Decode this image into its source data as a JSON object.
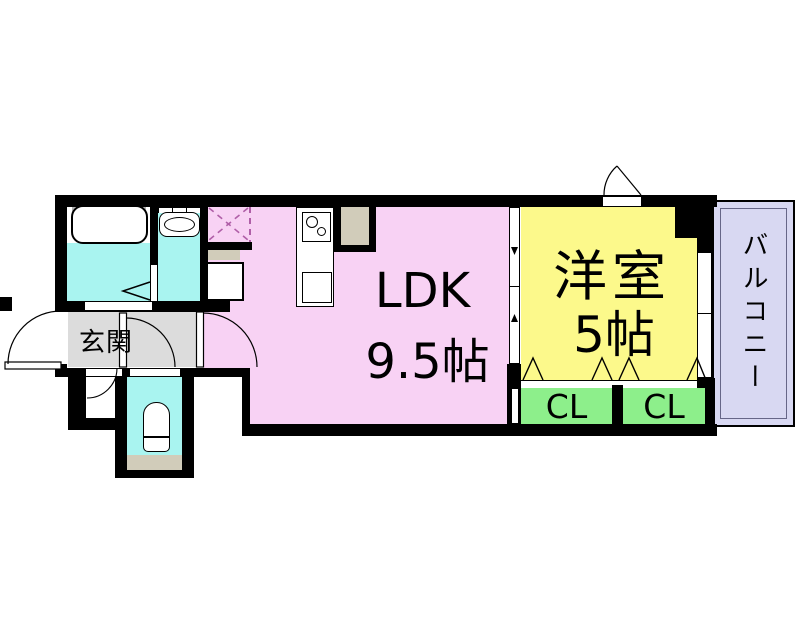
{
  "plan": {
    "labels": {
      "ldk": "LDK",
      "ldk_size": "9.5帖",
      "western_room": "洋室",
      "western_room_size": "5帖",
      "balcony": "バルコニー",
      "entrance": "玄関",
      "closet_left": "CL",
      "closet_right": "CL"
    },
    "colors": {
      "wall": "#000000",
      "ldk": "#f8d2f4",
      "western_room": "#fcf98b",
      "closet": "#8def8b",
      "balcony": "#d8d8f2",
      "wet_area": "#a9f4f0",
      "entrance": "#dcdcdc",
      "shelf": "#d1ccba",
      "hatch": "#b05fa8",
      "fixture": "#ffffff",
      "tub_rim": "#b0b0b0",
      "balcony_inner_line": "#666688"
    }
  }
}
